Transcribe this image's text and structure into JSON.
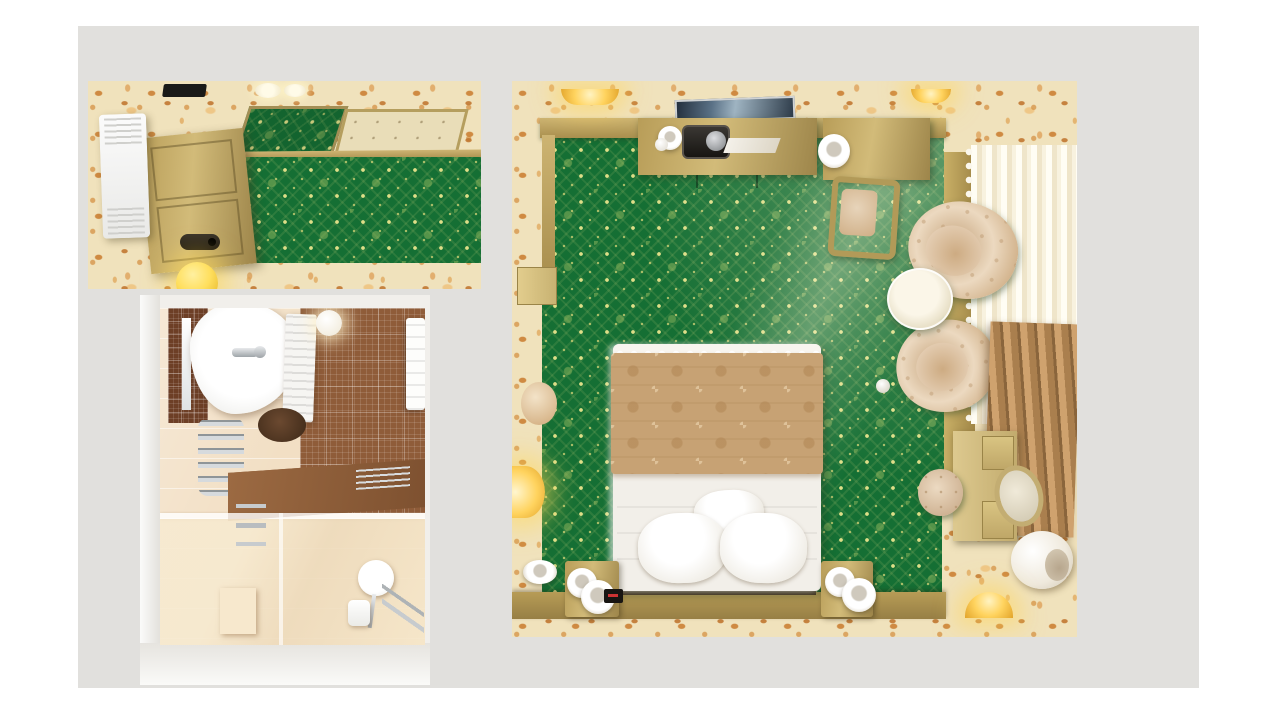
{
  "scene": {
    "type": "3d-interior-render-top-view",
    "description": "Photorealistic top-down 3D renders of a hotel suite shown as three panels on a light grey canvas: entry hallway (top left), bathroom (bottom left) and bedroom (right).",
    "rooms": [
      {
        "id": "hallway",
        "label": "Entry hallway — top-down view"
      },
      {
        "id": "bathroom",
        "label": "Bathroom — top-down view"
      },
      {
        "id": "bedroom",
        "label": "Bedroom — top-down view"
      }
    ]
  },
  "colors": {
    "page_bg": "#ffffff",
    "canvas_bg": "#e1e0dd",
    "wallpaper_cream": "#f0e2bc",
    "wallpaper_orange": "#d0933f",
    "carpet_green": "#156f34",
    "carpet_gold": "#d9d87e",
    "wood_gold": "#bfa55e",
    "wood_gold_dark": "#8f7a43",
    "door_gold": "#c4ab63",
    "ac_white": "#f7f7f6",
    "tv_screen": "#31404f",
    "bedspread_tan": "#c7a274",
    "linen_white": "#f2efe9",
    "headboard_brown": "#5e4430",
    "armchair_beige": "#e2cbb0",
    "sheer_white": "#f7f1e1",
    "drape_brown": "#b5885a",
    "tile_cream": "#f2dfc4",
    "mosaic_brown": "#8f5c39",
    "mosaic_dark": "#6d3f26",
    "counter_brown": "#8e5f3a",
    "chrome": "#c7cbce",
    "glow_yellow": "#ffd75e",
    "niche_white": "#f1efeb",
    "vent_black": "#1a1a18"
  },
  "hallway": {
    "label": "Entry hallway — top-down view",
    "items": [
      "floral-wallpaper-walls",
      "ceiling-vent",
      "ceiling-spotlights",
      "mirrored-ceiling-panel",
      "gold-ceiling-panel",
      "gold-trim",
      "air-conditioner",
      "entry-door",
      "door-lock",
      "green-damask-carpet",
      "sphere-lamp"
    ]
  },
  "bathroom": {
    "label": "Bathroom — top-down view",
    "items": [
      "white-niche-frame",
      "cream-wall-tiles",
      "brown-mosaic-wall",
      "dark-mosaic-panel",
      "vanity-sink",
      "faucet",
      "mirror-strip",
      "shutter-cabinet",
      "waste-bin",
      "towel-radiator",
      "ceiling-globe-light",
      "hanging-towels",
      "stone-counter",
      "chrome-rack",
      "glass-shower-partition",
      "shower-floor",
      "shower-step",
      "shower-fixtures",
      "magnifying-mirror",
      "soap-dish",
      "grab-bars"
    ]
  },
  "bedroom": {
    "label": "Bedroom — top-down view",
    "items": [
      "floral-wallpaper-walls",
      "green-damask-carpet",
      "wall-tv",
      "wall-sconce-left",
      "wall-sconce-right",
      "console-dresser",
      "coffee-cup",
      "milk-creamer",
      "espresso-machine",
      "folded-cloth",
      "writing-desk",
      "desk-lamp",
      "desk-chair",
      "tufted-armchair-upper",
      "tufted-armchair-lower",
      "round-glass-coffee-table",
      "window-ledge",
      "sheer-window-curtain",
      "lace-trim",
      "brown-drape",
      "dressing-table",
      "vanity-drawers",
      "round-vanity-mirror",
      "pouf-stool",
      "sphere-floor-lamp",
      "bottom-wall-sconce",
      "gold-baseboard",
      "double-bed",
      "damask-bedspread",
      "white-duvet",
      "pillow-small",
      "pillow-left",
      "pillow-right",
      "headboard-strip",
      "nightstand-left",
      "nightstand-right",
      "cylinder-lamp",
      "alarm-clock",
      "wall-lamp-ball",
      "wall-lamp-dome",
      "wall-lamp-ring"
    ]
  }
}
